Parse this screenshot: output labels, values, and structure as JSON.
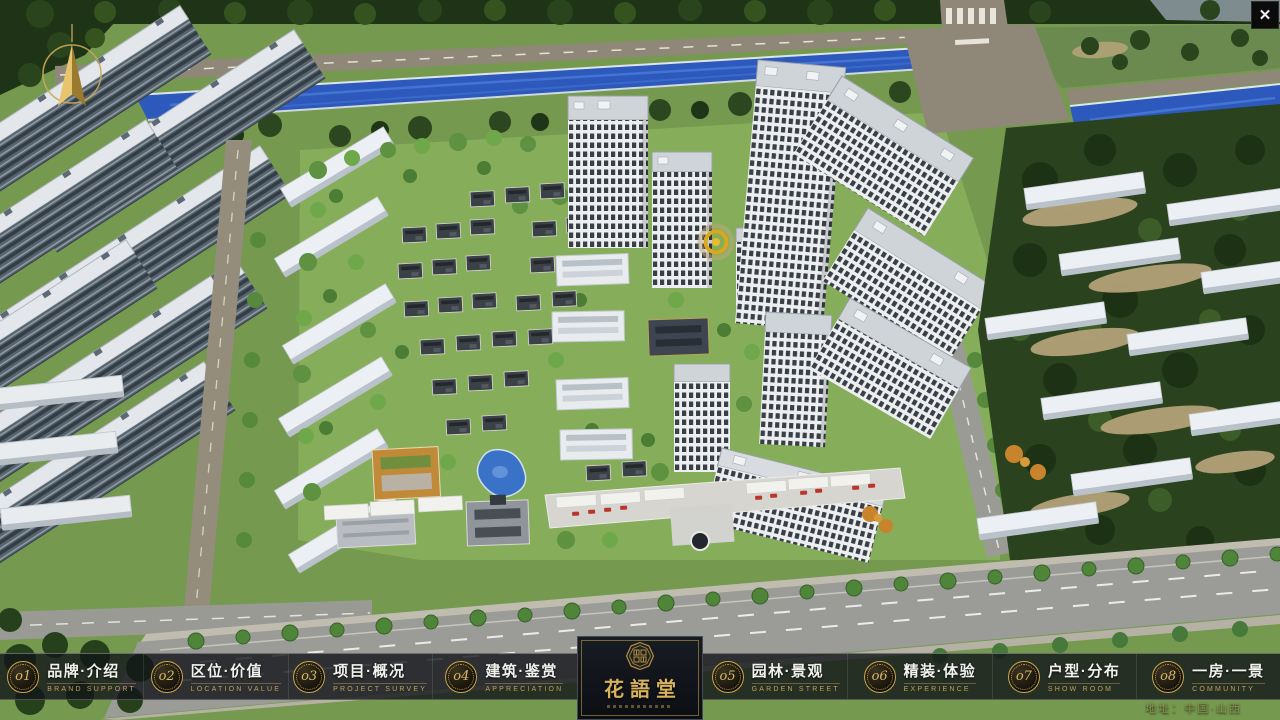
{
  "window": {
    "close_glyph": "✕"
  },
  "nav": {
    "items": [
      {
        "num": "o1",
        "label": "品牌·介绍",
        "sub": "BRAND SUPPORT"
      },
      {
        "num": "o2",
        "label": "区位·价值",
        "sub": "LOCATION VALUE"
      },
      {
        "num": "o3",
        "label": "项目·概况",
        "sub": "PROJECT SURVEY"
      },
      {
        "num": "o4",
        "label": "建筑·鉴赏",
        "sub": "APPRECIATION"
      },
      {
        "num": "o5",
        "label": "园林·景观",
        "sub": "GARDEN STREET"
      },
      {
        "num": "o6",
        "label": "精装·体验",
        "sub": "EXPERIENCE"
      },
      {
        "num": "o7",
        "label": "户型·分布",
        "sub": "SHOW ROOM"
      },
      {
        "num": "o8",
        "label": "一房·一景",
        "sub": "COMMUNITY"
      }
    ],
    "logo": {
      "title": "花語堂"
    }
  },
  "footer": {
    "address": "地址：中国·山西"
  },
  "colors": {
    "gold": "#c9a24f",
    "nav_text": "#f1f1ee",
    "nav_sub": "#bfa05a",
    "logo_bg": "#10141b",
    "river": "#2d59bd",
    "grass": "#7ba05b",
    "dark_trees": "#22361a",
    "road": "#8f8878",
    "main_road": "#9b9b97"
  }
}
